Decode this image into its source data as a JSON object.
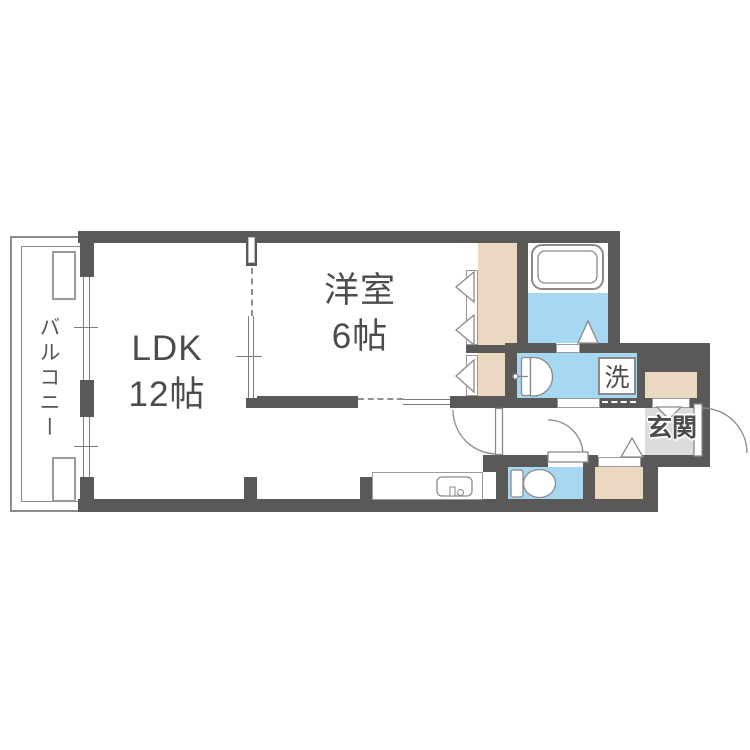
{
  "title": "apartment-floor-plan",
  "labels": {
    "balcony": "バルコニー",
    "ldk_name": "LDK",
    "ldk_size": "12帖",
    "western_room_name": "洋室",
    "western_room_size": "6帖",
    "washer": "洗",
    "entrance": "玄関"
  },
  "colors": {
    "bg": "#ffffff",
    "wall": "#5b5858",
    "water": "#a7d8f1",
    "closet": "#ead8c0",
    "genkan": "#dcdcdc",
    "line": "#8a8a8a",
    "text": "#4c4c4c"
  },
  "fixtures": [
    "bathtub",
    "washbasin",
    "washing-machine-space",
    "toilet",
    "kitchen-sink",
    "door-swing-arcs",
    "closet-folding-doors",
    "sliding-windows"
  ]
}
